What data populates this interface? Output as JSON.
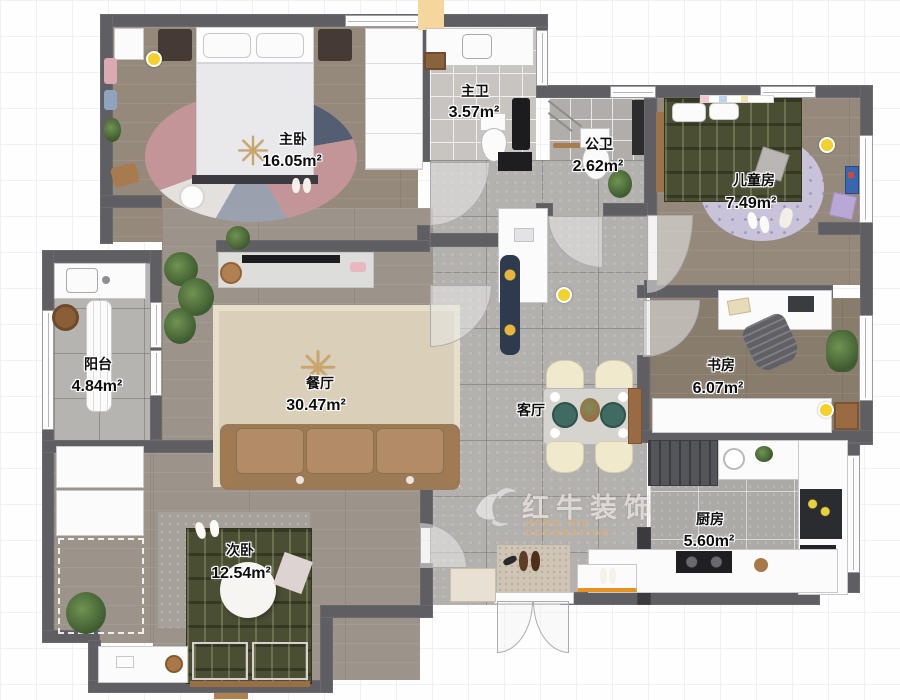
{
  "meta": {
    "title": "apartment-floor-plan"
  },
  "watermark": {
    "brand": "红牛装饰",
    "subtitle": "HONG NIU DECORATION"
  },
  "rooms": [
    {
      "id": "master-bedroom",
      "name": "主卧",
      "area": "16.05m²"
    },
    {
      "id": "master-bath",
      "name": "主卫",
      "area": "3.57m²"
    },
    {
      "id": "public-bath",
      "name": "公卫",
      "area": "2.62m²"
    },
    {
      "id": "kids-room",
      "name": "儿童房",
      "area": "7.49m²"
    },
    {
      "id": "study",
      "name": "书房",
      "area": "6.07m²"
    },
    {
      "id": "balcony",
      "name": "阳台",
      "area": "4.84m²"
    },
    {
      "id": "dining",
      "name": "餐厅",
      "area": "30.47m²"
    },
    {
      "id": "living",
      "name": "客厅",
      "area": ""
    },
    {
      "id": "kitchen",
      "name": "厨房",
      "area": "5.60m²"
    },
    {
      "id": "second-bedroom",
      "name": "次卧",
      "area": "12.54m²"
    }
  ],
  "colors": {
    "wall": "#5e5e63",
    "wood_floor": "#95897c",
    "tile_floor": "#b3b1ae",
    "rug_dining": "#dacfb8",
    "sofa": "#a9855f",
    "bed_green": "#4a4e33",
    "accent_light_dot": "#f2d12b",
    "watermark_orange": "#e8b068"
  }
}
